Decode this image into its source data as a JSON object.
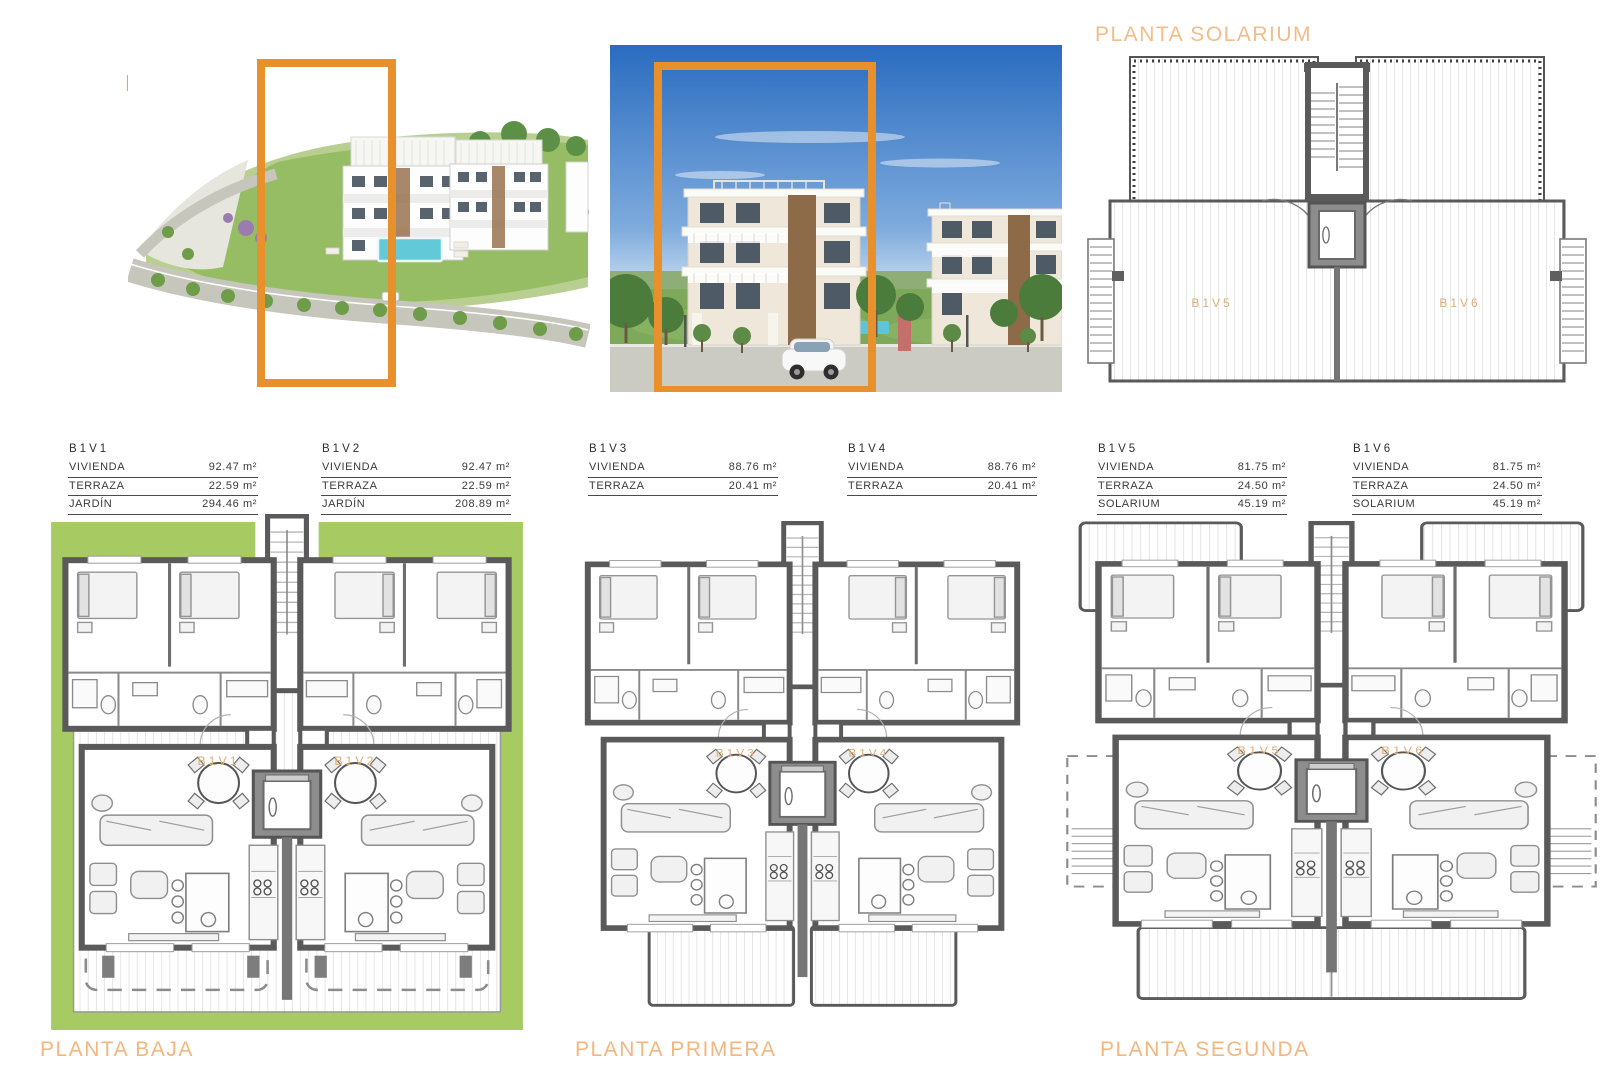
{
  "headings": {
    "bloque": "BLOQUE 1",
    "solarium": "PLANTA SOLARIUM"
  },
  "unit_tables": [
    {
      "id": "B1V1",
      "rows": [
        {
          "label": "VIVIENDA",
          "value": "92.47 m²"
        },
        {
          "label": "TERRAZA",
          "value": "22.59 m²"
        },
        {
          "label": "JARDÍN",
          "value": "294.46 m²"
        }
      ]
    },
    {
      "id": "B1V2",
      "rows": [
        {
          "label": "VIVIENDA",
          "value": "92.47 m²"
        },
        {
          "label": "TERRAZA",
          "value": "22.59 m²"
        },
        {
          "label": "JARDÍN",
          "value": "208.89 m²"
        }
      ]
    },
    {
      "id": "B1V3",
      "rows": [
        {
          "label": "VIVIENDA",
          "value": "88.76 m²"
        },
        {
          "label": "TERRAZA",
          "value": "20.41 m²"
        }
      ]
    },
    {
      "id": "B1V4",
      "rows": [
        {
          "label": "VIVIENDA",
          "value": "88.76 m²"
        },
        {
          "label": "TERRAZA",
          "value": "20.41 m²"
        }
      ]
    },
    {
      "id": "B1V5",
      "rows": [
        {
          "label": "VIVIENDA",
          "value": "81.75 m²"
        },
        {
          "label": "TERRAZA",
          "value": "24.50 m²"
        },
        {
          "label": "SOLARIUM",
          "value": "45.19 m²"
        }
      ]
    },
    {
      "id": "B1V6",
      "rows": [
        {
          "label": "VIVIENDA",
          "value": "81.75 m²"
        },
        {
          "label": "TERRAZA",
          "value": "24.50 m²"
        },
        {
          "label": "SOLARIUM",
          "value": "45.19 m²"
        }
      ]
    }
  ],
  "plans": {
    "solarium": {
      "units": [
        "B1V5",
        "B1V6"
      ]
    },
    "baja": {
      "title": "PLANTA BAJA",
      "units": [
        "B1V1",
        "B1V2"
      ]
    },
    "primera": {
      "title": "PLANTA PRIMERA",
      "units": [
        "B1V3",
        "B1V4"
      ]
    },
    "segunda": {
      "title": "PLANTA SEGUNDA",
      "units": [
        "B1V5",
        "B1V6"
      ]
    }
  },
  "colors": {
    "accent_orange": "#E8912C",
    "heading_orange": "#EFA25F",
    "plan_unit_label": "#DCAE79",
    "garden_green": "#A7CB62"
  }
}
